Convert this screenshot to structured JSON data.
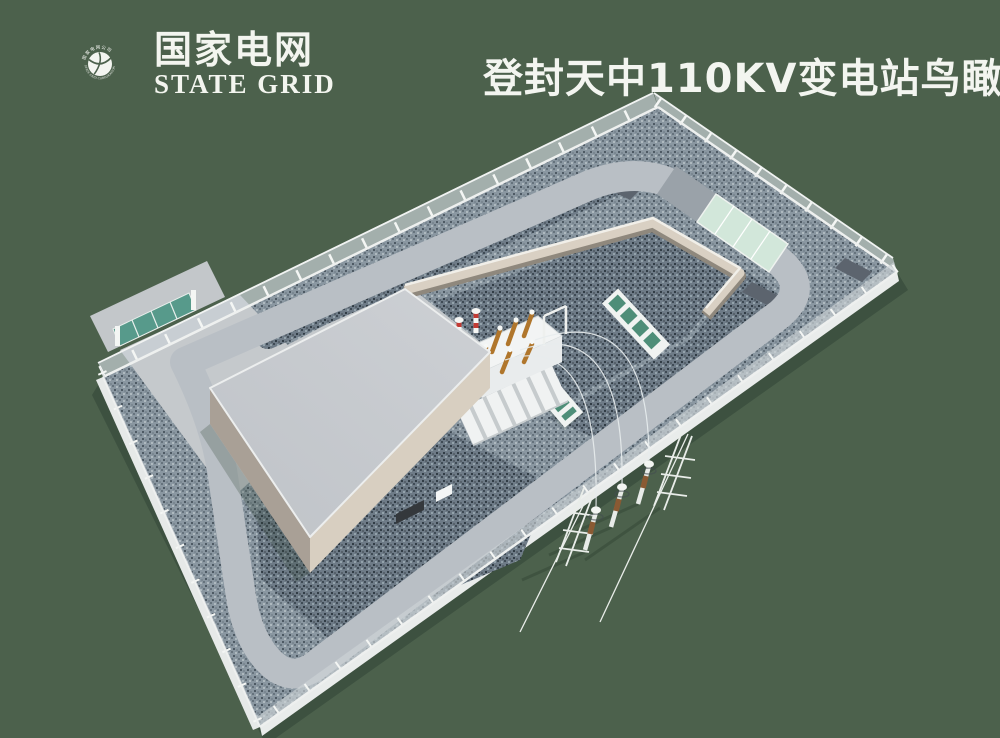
{
  "page": {
    "background_color": "#4c614c"
  },
  "logo": {
    "cn": "国家电网",
    "en": "STATE GRID",
    "ring_top": "国家电网公司",
    "ring_bottom": "STATE GRID CORPORATION OF CHINA",
    "color": "#f3f5ef"
  },
  "title": {
    "text": "登封天中110KV变电站鸟瞰图",
    "color": "#f3f5f0"
  },
  "scene": {
    "colors": {
      "background_green": "#4c614c",
      "gravel_gray_blue": "#8a97a1",
      "gravel_dark": "#6e7b87",
      "pavement": "#c5c9cc",
      "road": "#b9bfc5",
      "roof": "#c7cace",
      "building_wall_lit": "#d8cfc1",
      "building_wall_shade": "#a9a096",
      "fence_white": "#f1f3f2",
      "gate_teal": "#579a8b",
      "pad_mint": "#d2e7da",
      "transformer_white": "#f0f2f2",
      "bushing_orange": "#b0762c",
      "arrester_red": "#c23b34"
    }
  }
}
